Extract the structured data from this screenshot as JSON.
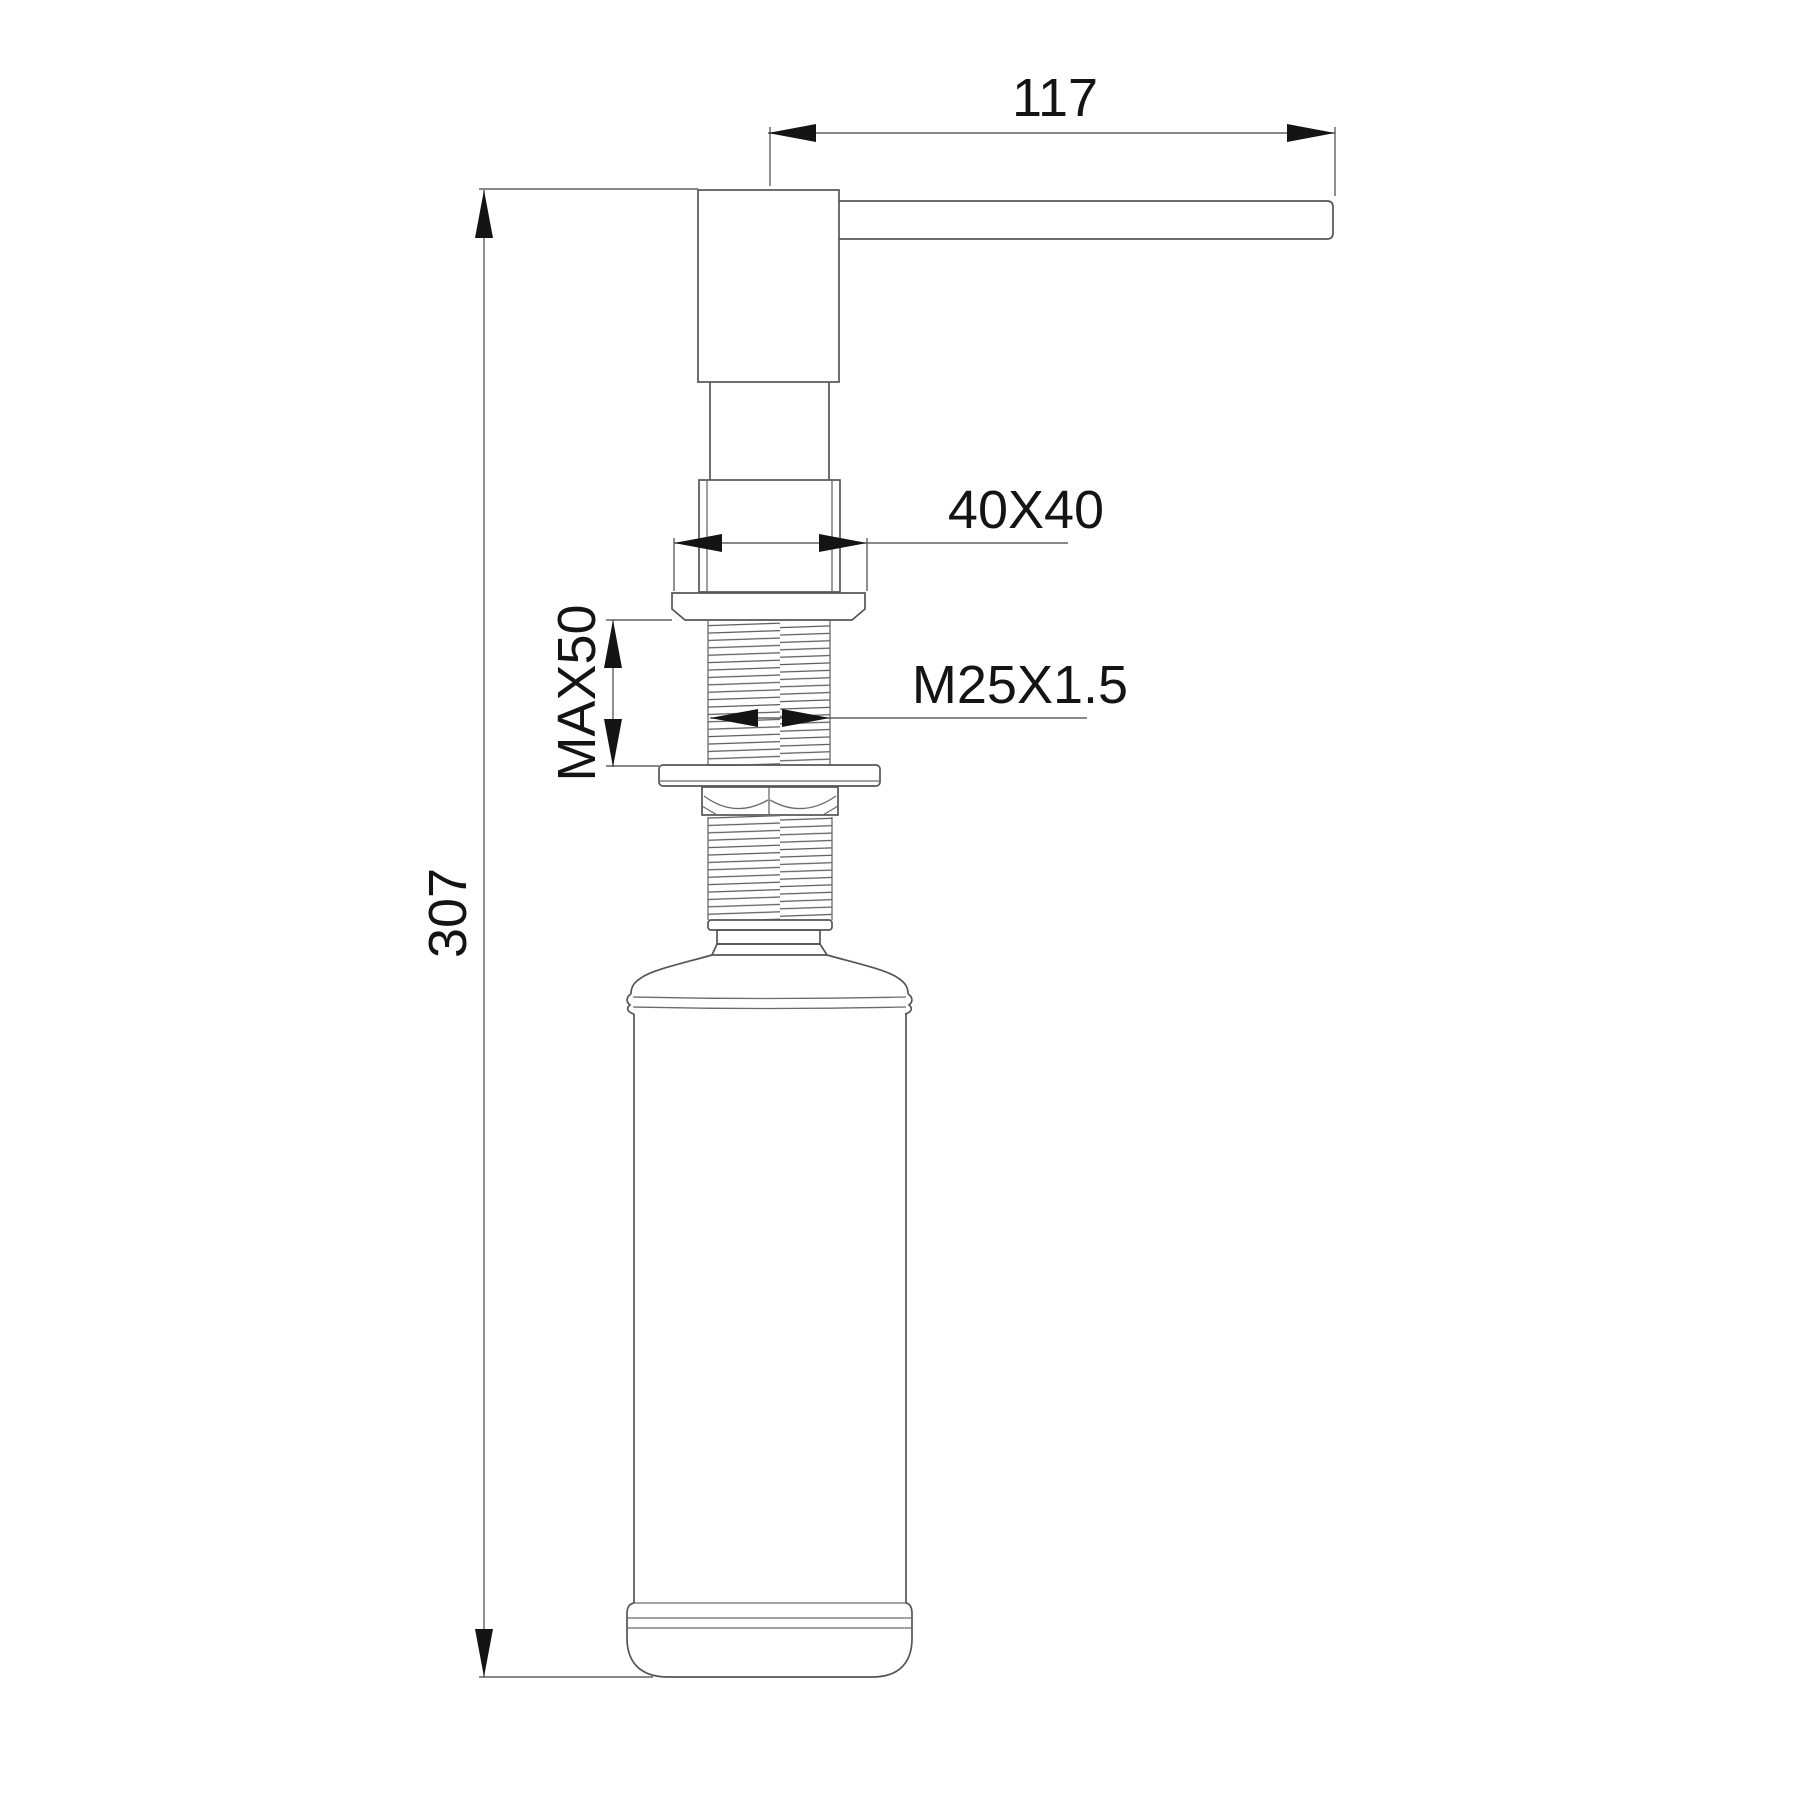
{
  "drawing": {
    "type": "technical-dimension-drawing",
    "subject": "soap-dispenser-side-view",
    "labels": {
      "spout_reach": "117",
      "flange_size": "40X40",
      "max_mount_thickness": "MAX50",
      "thread_spec": "M25X1.5",
      "overall_height": "307"
    },
    "colors": {
      "background": "#ffffff",
      "object_line": "#555555",
      "dimension_line": "#606060",
      "arrow_and_text": "#141414"
    }
  }
}
